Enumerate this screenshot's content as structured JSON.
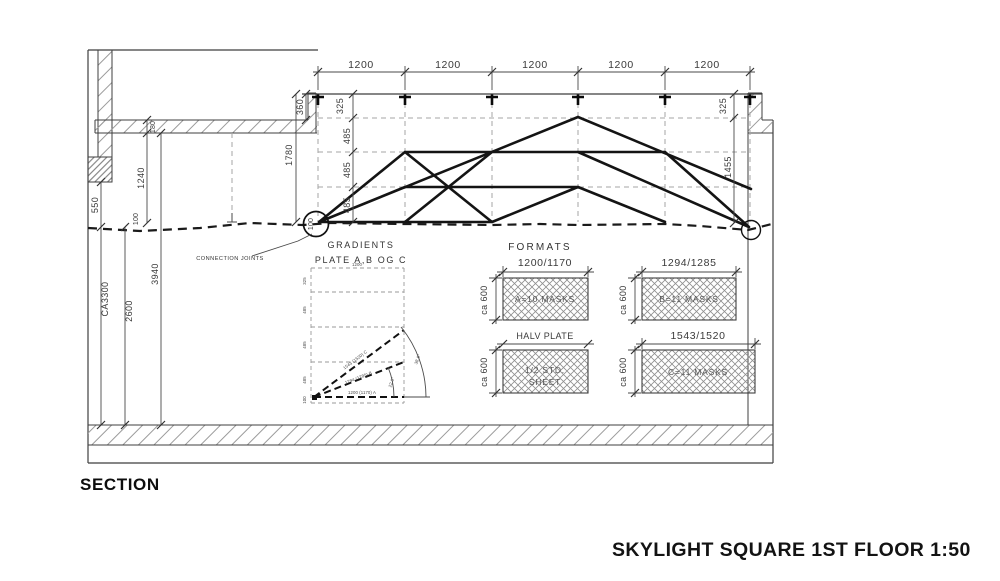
{
  "titles": {
    "section": "SECTION",
    "drawing": "SKYLIGHT SQUARE 1ST FLOOR 1:50"
  },
  "colors": {
    "thin_line": "#3f3f3f",
    "thick_line": "#141414",
    "dashed_grid": "#a6a6a6",
    "hatch": "#9b9b9b",
    "text": "#3a3a3a"
  },
  "dims": {
    "top": [
      "1200",
      "1200",
      "1200",
      "1200",
      "1200"
    ],
    "chain_left": [
      "325",
      "485",
      "485",
      "485"
    ],
    "chain_right": [
      "325",
      "1455"
    ],
    "d1780": "1780",
    "d360": "360",
    "d550": "550",
    "ca3300": "CA3300",
    "d2600": "2600",
    "d1240": "1240",
    "d180": "180",
    "d3940": "3940",
    "d100": "100",
    "d100_node": "100"
  },
  "annotations": {
    "connection_joints": "CONNECTION JOINTS"
  },
  "gradients": {
    "title": "GRADIENTS",
    "subtitle": "PLATE A,B OG C",
    "top_dim": "1200",
    "ticks": [
      "325",
      "485",
      "485",
      "485",
      "100"
    ],
    "lines": {
      "a": "1200 (1170) A",
      "b": "1294 (1285) B",
      "c": "1543 (1520) C"
    },
    "angles": {
      "inner": "22.0°",
      "outer": "38.9°"
    }
  },
  "formats": {
    "title": "FORMATS",
    "panels": [
      {
        "dim": "1200/1170",
        "side": "ca 600",
        "label": "A=10 MASKS"
      },
      {
        "dim": "1294/1285",
        "side": "ca 600",
        "label": "B=11 MASKS"
      },
      {
        "dim": "HALV PLATE",
        "side": "ca 600",
        "label1": "1/2 STD.",
        "label2": "SHEET"
      },
      {
        "dim": "1543/1520",
        "side": "ca 600",
        "label": "C=11 MASKS"
      }
    ]
  }
}
